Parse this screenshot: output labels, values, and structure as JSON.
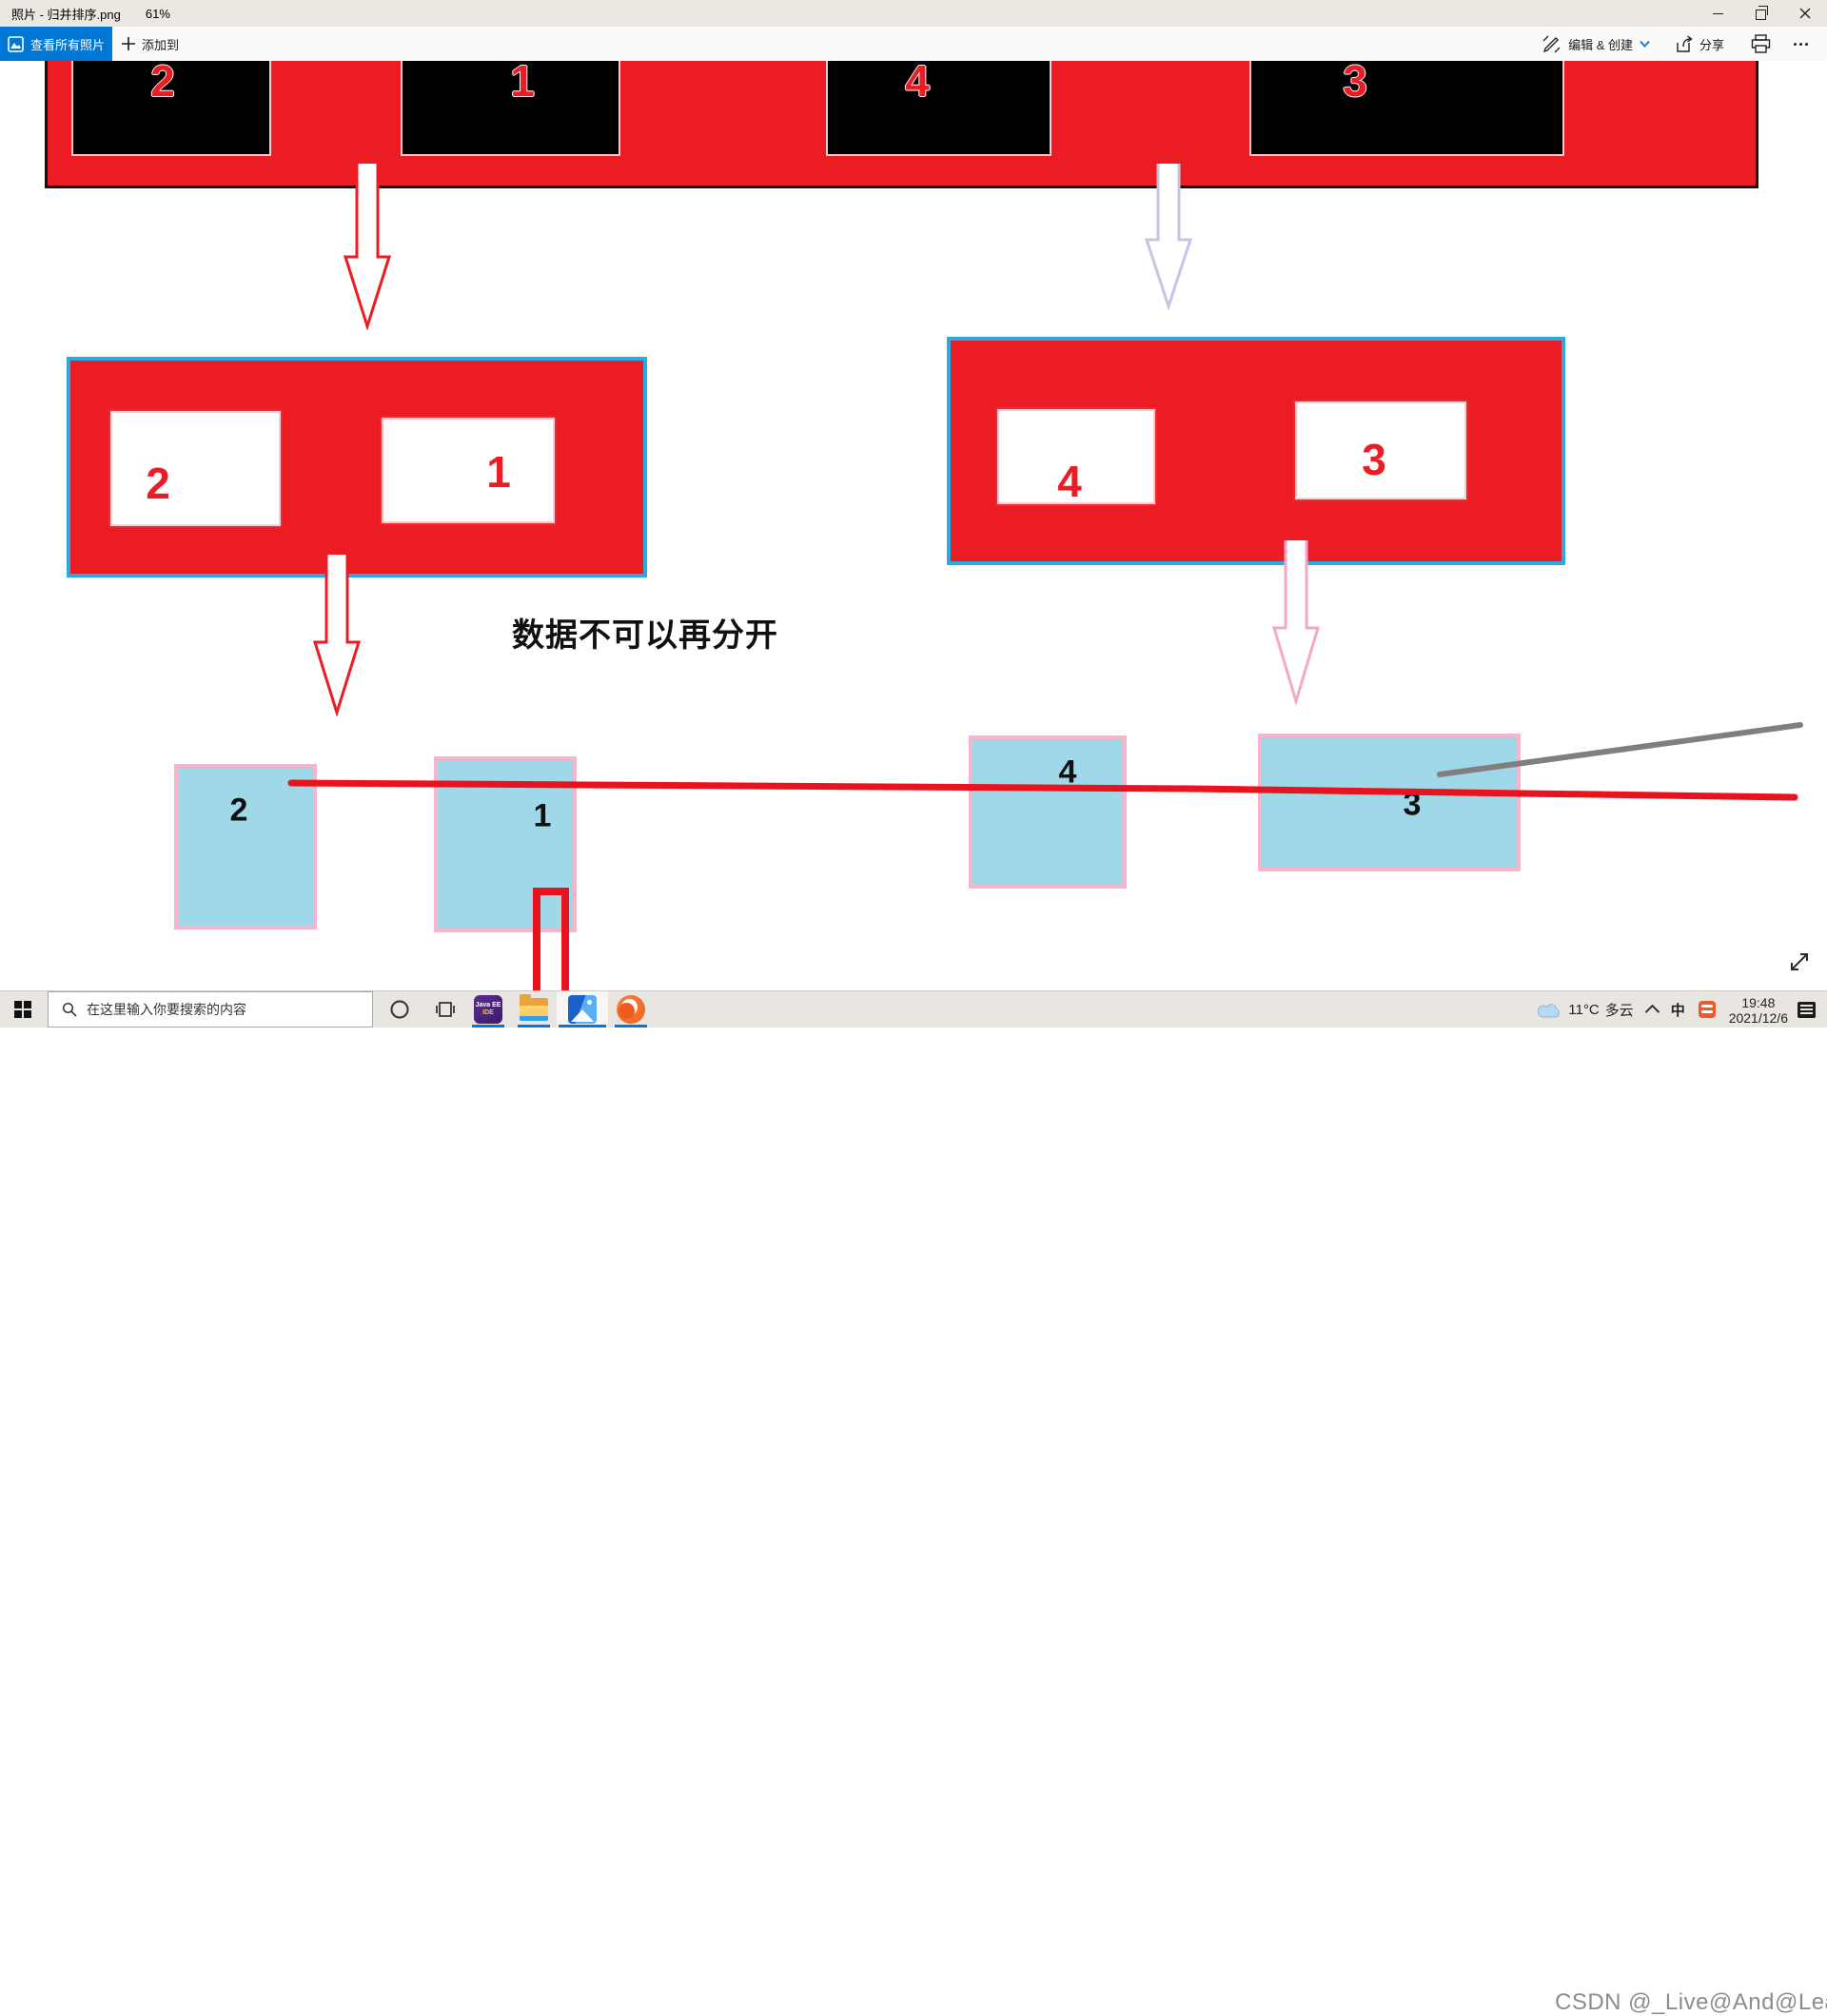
{
  "window": {
    "title": "照片 - 归并排序.png",
    "zoom_level": "61%"
  },
  "toolbar": {
    "view_all_label": "查看所有照片",
    "add_to_label": "添加到",
    "edit_create_label": "编辑 & 创建",
    "share_label": "分享"
  },
  "diagram": {
    "top_row": [
      "2",
      "1",
      "4",
      "3"
    ],
    "left_group": [
      "2",
      "1"
    ],
    "right_group": [
      "4",
      "3"
    ],
    "bottom_row": [
      "2",
      "1",
      "4",
      "3"
    ],
    "note": "数据不可以再分开"
  },
  "taskbar": {
    "search_placeholder": "在这里输入你要搜索的内容",
    "weather_temp": "11°C",
    "weather_desc": "多云",
    "ime_mode": "中",
    "time": "19:48",
    "date": "2021/12/6",
    "watermark": "CSDN @_Live@And@Learn@#"
  },
  "colors": {
    "accent_blue": "#0078d7",
    "diagram_red": "#ec1c24",
    "group_border_blue": "#29abe2",
    "lavender_arrow": "#c8c3e4",
    "pink_arrow": "#f6a6c6",
    "pink_border": "#f9b3cd",
    "cyan_fill": "#9fd8e8"
  }
}
